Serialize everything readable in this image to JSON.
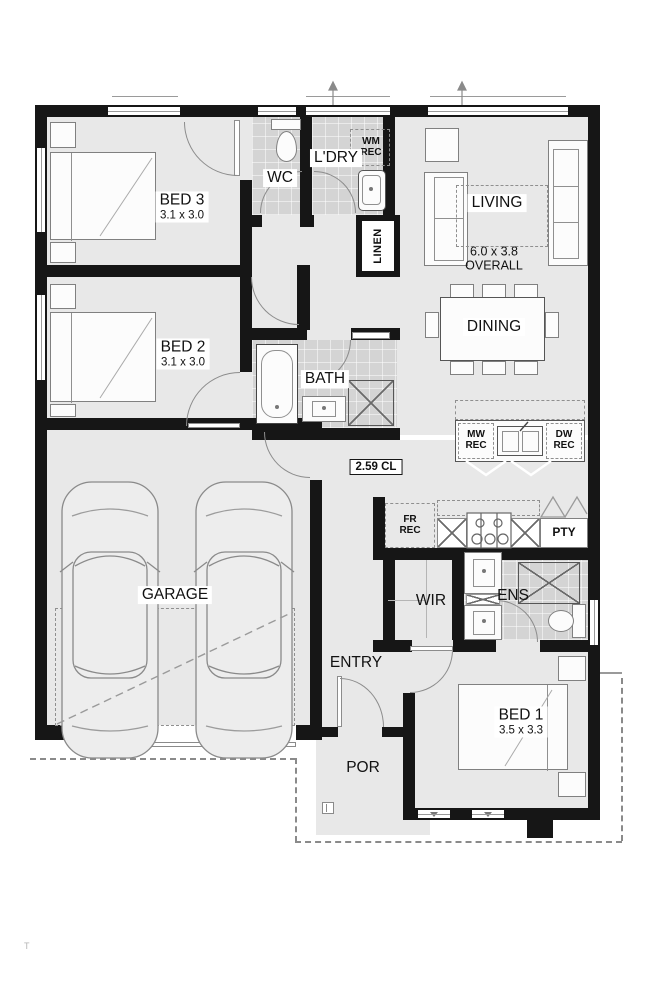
{
  "plan_title": "single-storey house floor plan",
  "rooms": {
    "bed3": {
      "label": "BED 3",
      "dim": "3.1 x 3.0"
    },
    "bed2": {
      "label": "BED 2",
      "dim": "3.1 x 3.0"
    },
    "bed1": {
      "label": "BED 1",
      "dim": "3.5 x 3.3"
    },
    "wc": {
      "label": "WC"
    },
    "ldry": {
      "label": "L'DRY"
    },
    "linen": {
      "label": "LINEN"
    },
    "living": {
      "label": "LIVING",
      "overall": "6.0 x 3.8\nOVERALL"
    },
    "dining": {
      "label": "DINING"
    },
    "bath": {
      "label": "BATH"
    },
    "garage": {
      "label": "GARAGE"
    },
    "wir": {
      "label": "WIR"
    },
    "ens": {
      "label": "ENS"
    },
    "entry": {
      "label": "ENTRY"
    },
    "por": {
      "label": "POR"
    },
    "pty": {
      "label": "PTY"
    }
  },
  "recesses": {
    "wm": "WM\nREC",
    "mw": "MW\nREC",
    "dw": "DW\nREC",
    "fr": "FR\nREC"
  },
  "annotations": {
    "ceiling_height": "2.59 CL",
    "watermark": "T"
  },
  "colors": {
    "wall": "#161616",
    "floor": "#e8e8e8",
    "wet_area_tile": "#d4d4d4",
    "furniture_line": "#808080",
    "boundary_line": "#8a8a8a",
    "paper": "#ffffff"
  }
}
